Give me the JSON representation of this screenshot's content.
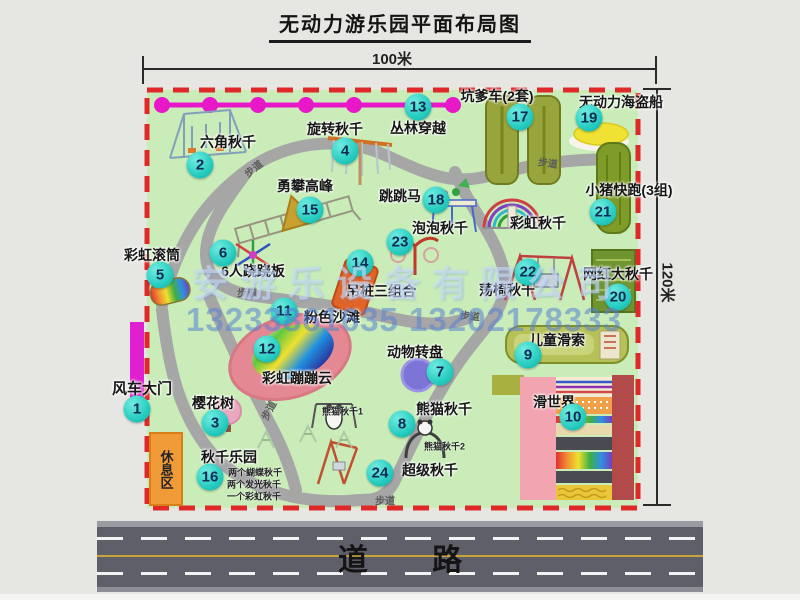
{
  "title": "无动力游乐园平面布局图",
  "dimensions": {
    "width_label": "100米",
    "height_label": "120米"
  },
  "road": {
    "label": "道 路"
  },
  "rest_area": {
    "label": "休息区"
  },
  "watermark": {
    "company": "安游乐设备有限公司",
    "phone": "13233861635 13202178333"
  },
  "colors": {
    "map_green": "#c9ecb8",
    "border_red": "#e02828",
    "badge_cyan": "#27ccc0",
    "rope_magenta": "#e818c8",
    "road_gray": "#5f5f6a",
    "rest_orange": "#f09a38"
  },
  "map": {
    "items": [
      {
        "num": "1",
        "label": "风车大门",
        "lx": 142,
        "ly": 388,
        "bx": 137,
        "by": 409,
        "size": 15
      },
      {
        "num": "2",
        "label": "六角秋千",
        "lx": 228,
        "ly": 142,
        "bx": 200,
        "by": 165
      },
      {
        "num": "3",
        "label": "樱花树",
        "lx": 213,
        "ly": 403,
        "bx": 215,
        "by": 423
      },
      {
        "num": "4",
        "label": "旋转秋千",
        "lx": 335,
        "ly": 129,
        "bx": 345,
        "by": 151
      },
      {
        "num": "5",
        "label": "彩虹滚筒",
        "lx": 152,
        "ly": 255,
        "bx": 160,
        "by": 275
      },
      {
        "num": "6",
        "label": "6人跷跷板",
        "lx": 253,
        "ly": 271,
        "bx": 223,
        "by": 253
      },
      {
        "num": "7",
        "label": "动物转盘",
        "lx": 415,
        "ly": 352,
        "bx": 440,
        "by": 372
      },
      {
        "num": "8",
        "label": "熊猫秋千",
        "lx": 444,
        "ly": 409,
        "bx": 402,
        "by": 424,
        "subs": [
          {
            "text": "熊猫秋千1",
            "x": 322,
            "y": 411
          },
          {
            "text": "熊猫秋千2",
            "x": 424,
            "y": 446
          }
        ]
      },
      {
        "num": "9",
        "label": "儿童滑索",
        "lx": 557,
        "ly": 340,
        "bx": 528,
        "by": 355
      },
      {
        "num": "10",
        "label": "滑世界",
        "lx": 554,
        "ly": 402,
        "bx": 573,
        "by": 417
      },
      {
        "num": "11",
        "label": "粉色沙滩",
        "lx": 332,
        "ly": 317,
        "bx": 284,
        "by": 311
      },
      {
        "num": "12",
        "label": "彩虹蹦蹦云",
        "lx": 297,
        "ly": 378,
        "bx": 267,
        "by": 349
      },
      {
        "num": "13",
        "label": "丛林穿越",
        "lx": 418,
        "ly": 128,
        "bx": 418,
        "by": 107
      },
      {
        "num": "14",
        "label": "吊桩三组合",
        "lx": 381,
        "ly": 291,
        "bx": 360,
        "by": 263
      },
      {
        "num": "15",
        "label": "勇攀高峰",
        "lx": 305,
        "ly": 186,
        "bx": 310,
        "by": 210
      },
      {
        "num": "16",
        "label": "秋千乐园",
        "lx": 229,
        "ly": 457,
        "bx": 210,
        "by": 477,
        "subs": [
          {
            "text": "两个蝴蝶秋千",
            "x": 228,
            "y": 472
          },
          {
            "text": "两个发光秋千",
            "x": 227,
            "y": 484
          },
          {
            "text": "一个彩虹秋千",
            "x": 227,
            "y": 496
          }
        ]
      },
      {
        "num": "17",
        "label": "坑爹车(2套)",
        "lx": 497,
        "ly": 96,
        "bx": 520,
        "by": 117
      },
      {
        "num": "18",
        "label": "跳跳马",
        "lx": 400,
        "ly": 196,
        "bx": 436,
        "by": 200
      },
      {
        "num": "19",
        "label": "无动力海盗船",
        "lx": 621,
        "ly": 102,
        "bx": 589,
        "by": 118
      },
      {
        "num": "20",
        "label": "网红大秋千",
        "lx": 618,
        "ly": 274,
        "bx": 618,
        "by": 297
      },
      {
        "num": "21",
        "label": "小猪快跑(3组)",
        "lx": 629,
        "ly": 190,
        "bx": 603,
        "by": 212
      },
      {
        "num": "22",
        "label": "荡椅秋千",
        "lx": 507,
        "ly": 290,
        "bx": 528,
        "by": 272
      },
      {
        "num": "23",
        "label": "泡泡秋千",
        "lx": 440,
        "ly": 228,
        "bx": 400,
        "by": 242
      },
      {
        "num": "24",
        "label": "超级秋千",
        "lx": 430,
        "ly": 470,
        "bx": 380,
        "by": 473
      }
    ],
    "extra_labels": [
      {
        "text": "彩虹秋千",
        "x": 538,
        "y": 223
      }
    ],
    "path_labels": [
      {
        "text": "步道",
        "x": 253,
        "y": 168,
        "rot": -38
      },
      {
        "text": "步道",
        "x": 548,
        "y": 162,
        "rot": 8
      },
      {
        "text": "步道",
        "x": 247,
        "y": 292,
        "rot": 0
      },
      {
        "text": "步道",
        "x": 470,
        "y": 315,
        "rot": 5
      },
      {
        "text": "步道",
        "x": 268,
        "y": 410,
        "rot": -62
      },
      {
        "text": "步道",
        "x": 385,
        "y": 500,
        "rot": 0
      }
    ]
  }
}
